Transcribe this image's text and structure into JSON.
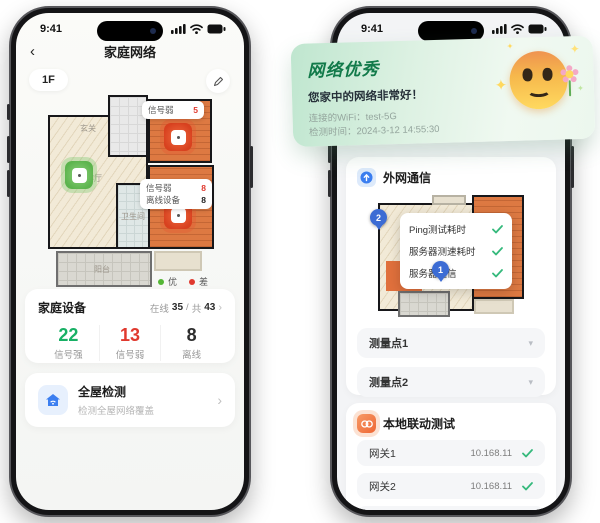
{
  "icons": {
    "back": "‹",
    "chevron_right": "›",
    "chevron_down": "▾",
    "sparkle": "✦"
  },
  "colors": {
    "accent_green": "#18b065",
    "accent_red": "#e0392e",
    "brand_blue": "#3c6cd4",
    "result_green": "#127a4a"
  },
  "left_phone": {
    "status_time": "9:41",
    "nav_title": "家庭网络",
    "floor_label": "1F",
    "plan": {
      "room_entry": "玄关",
      "room_kitchen": "厨房",
      "room_living": "客厅",
      "room_bath": "卫生间",
      "room_balcony": "阳台",
      "badge_top": {
        "label": "信号弱",
        "value": "5"
      },
      "badge_bottom": {
        "row1_label": "信号弱",
        "row1_value": "8",
        "row2_label": "离线设备",
        "row2_value": "8"
      },
      "legend": {
        "good": "优",
        "bad": "差"
      }
    },
    "devices": {
      "title": "家庭设备",
      "online_label": "在线",
      "online_value": "35",
      "divider": "/",
      "total_label": "共",
      "total_value": "43",
      "stats": [
        {
          "value": "22",
          "label": "信号强"
        },
        {
          "value": "13",
          "label": "信号弱"
        },
        {
          "value": "8",
          "label": "离线"
        }
      ]
    },
    "detect": {
      "title": "全屋检测",
      "subtitle": "检测全屋网络覆盖"
    }
  },
  "right_phone": {
    "status_time": "9:41",
    "result_card": {
      "title": "网络优秀",
      "subtitle": "您家中的网络非常好！",
      "wifi_label": "连接的WiFi：",
      "wifi_value": "test-5G",
      "time_label": "检测时间：",
      "time_value": "2024-3-12 14:55:30"
    },
    "wan": {
      "title": "外网通信",
      "pin_1": "1",
      "pin_2": "2",
      "tooltip": [
        {
          "label": "Ping测试耗时"
        },
        {
          "label": "服务器测速耗时"
        },
        {
          "label": "服务器通信"
        }
      ],
      "points": [
        {
          "label": "测量点1"
        },
        {
          "label": "测量点2"
        }
      ]
    },
    "lan": {
      "title": "本地联动测试",
      "rows": [
        {
          "label": "网关1",
          "ip": "10.168.11"
        },
        {
          "label": "网关2",
          "ip": "10.168.11"
        },
        {
          "label": "网关3",
          "ip": "10.168.11"
        }
      ]
    }
  }
}
